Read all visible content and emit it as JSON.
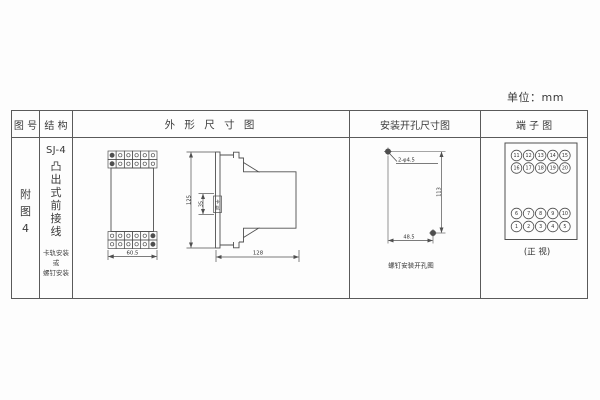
{
  "unit_label": "单位：mm",
  "colors": {
    "line": "#4f4f4f",
    "text": "#3a3a3a",
    "table_border": "#5a5a5a",
    "bg": "#fdfdfd"
  },
  "table": {
    "headers": [
      "图 号",
      "结 构",
      "外 形 尺 寸 图",
      "安装开孔尺寸图",
      "端 子 图"
    ]
  },
  "figure_no": {
    "chars": [
      "附",
      "图",
      "4"
    ]
  },
  "structure": {
    "model": "SJ-4",
    "type_chars": [
      "凸",
      "出",
      "式",
      "前",
      "接",
      "线"
    ],
    "mounting_notes": [
      "卡轨安装",
      "或",
      "螺钉安装"
    ]
  },
  "outline_drawing": {
    "front_width": "60.5",
    "height": "125",
    "rail_dim": "35",
    "rail_label_chars": [
      "卡",
      "轨"
    ],
    "depth": "128"
  },
  "install_drawing": {
    "hole_label": "2-φ4.5",
    "height": "113",
    "width": "48.5",
    "caption": "螺钉安装开孔图"
  },
  "terminal_diagram": {
    "rows": [
      [
        11,
        12,
        13,
        14,
        15
      ],
      [
        16,
        17,
        18,
        19,
        20
      ],
      [
        6,
        7,
        8,
        9,
        10
      ],
      [
        1,
        2,
        3,
        4,
        5
      ]
    ],
    "caption": "(正 视)"
  }
}
